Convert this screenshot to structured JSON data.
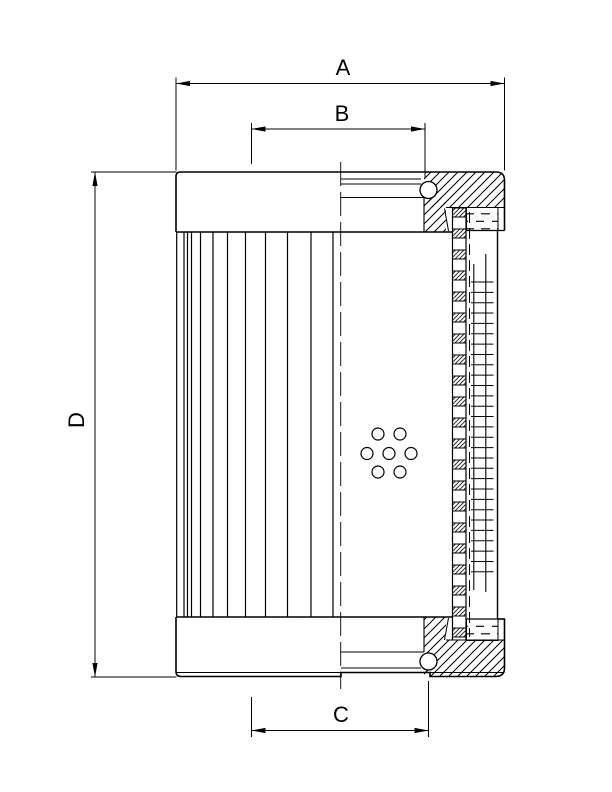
{
  "colors": {
    "ink": "#000000",
    "paper": "#ffffff"
  },
  "drawing": {
    "kind": "filter-element-cross-section",
    "labels": {
      "dim_a": "A",
      "dim_b": "B",
      "dim_c": "C",
      "dim_d": "D"
    }
  }
}
